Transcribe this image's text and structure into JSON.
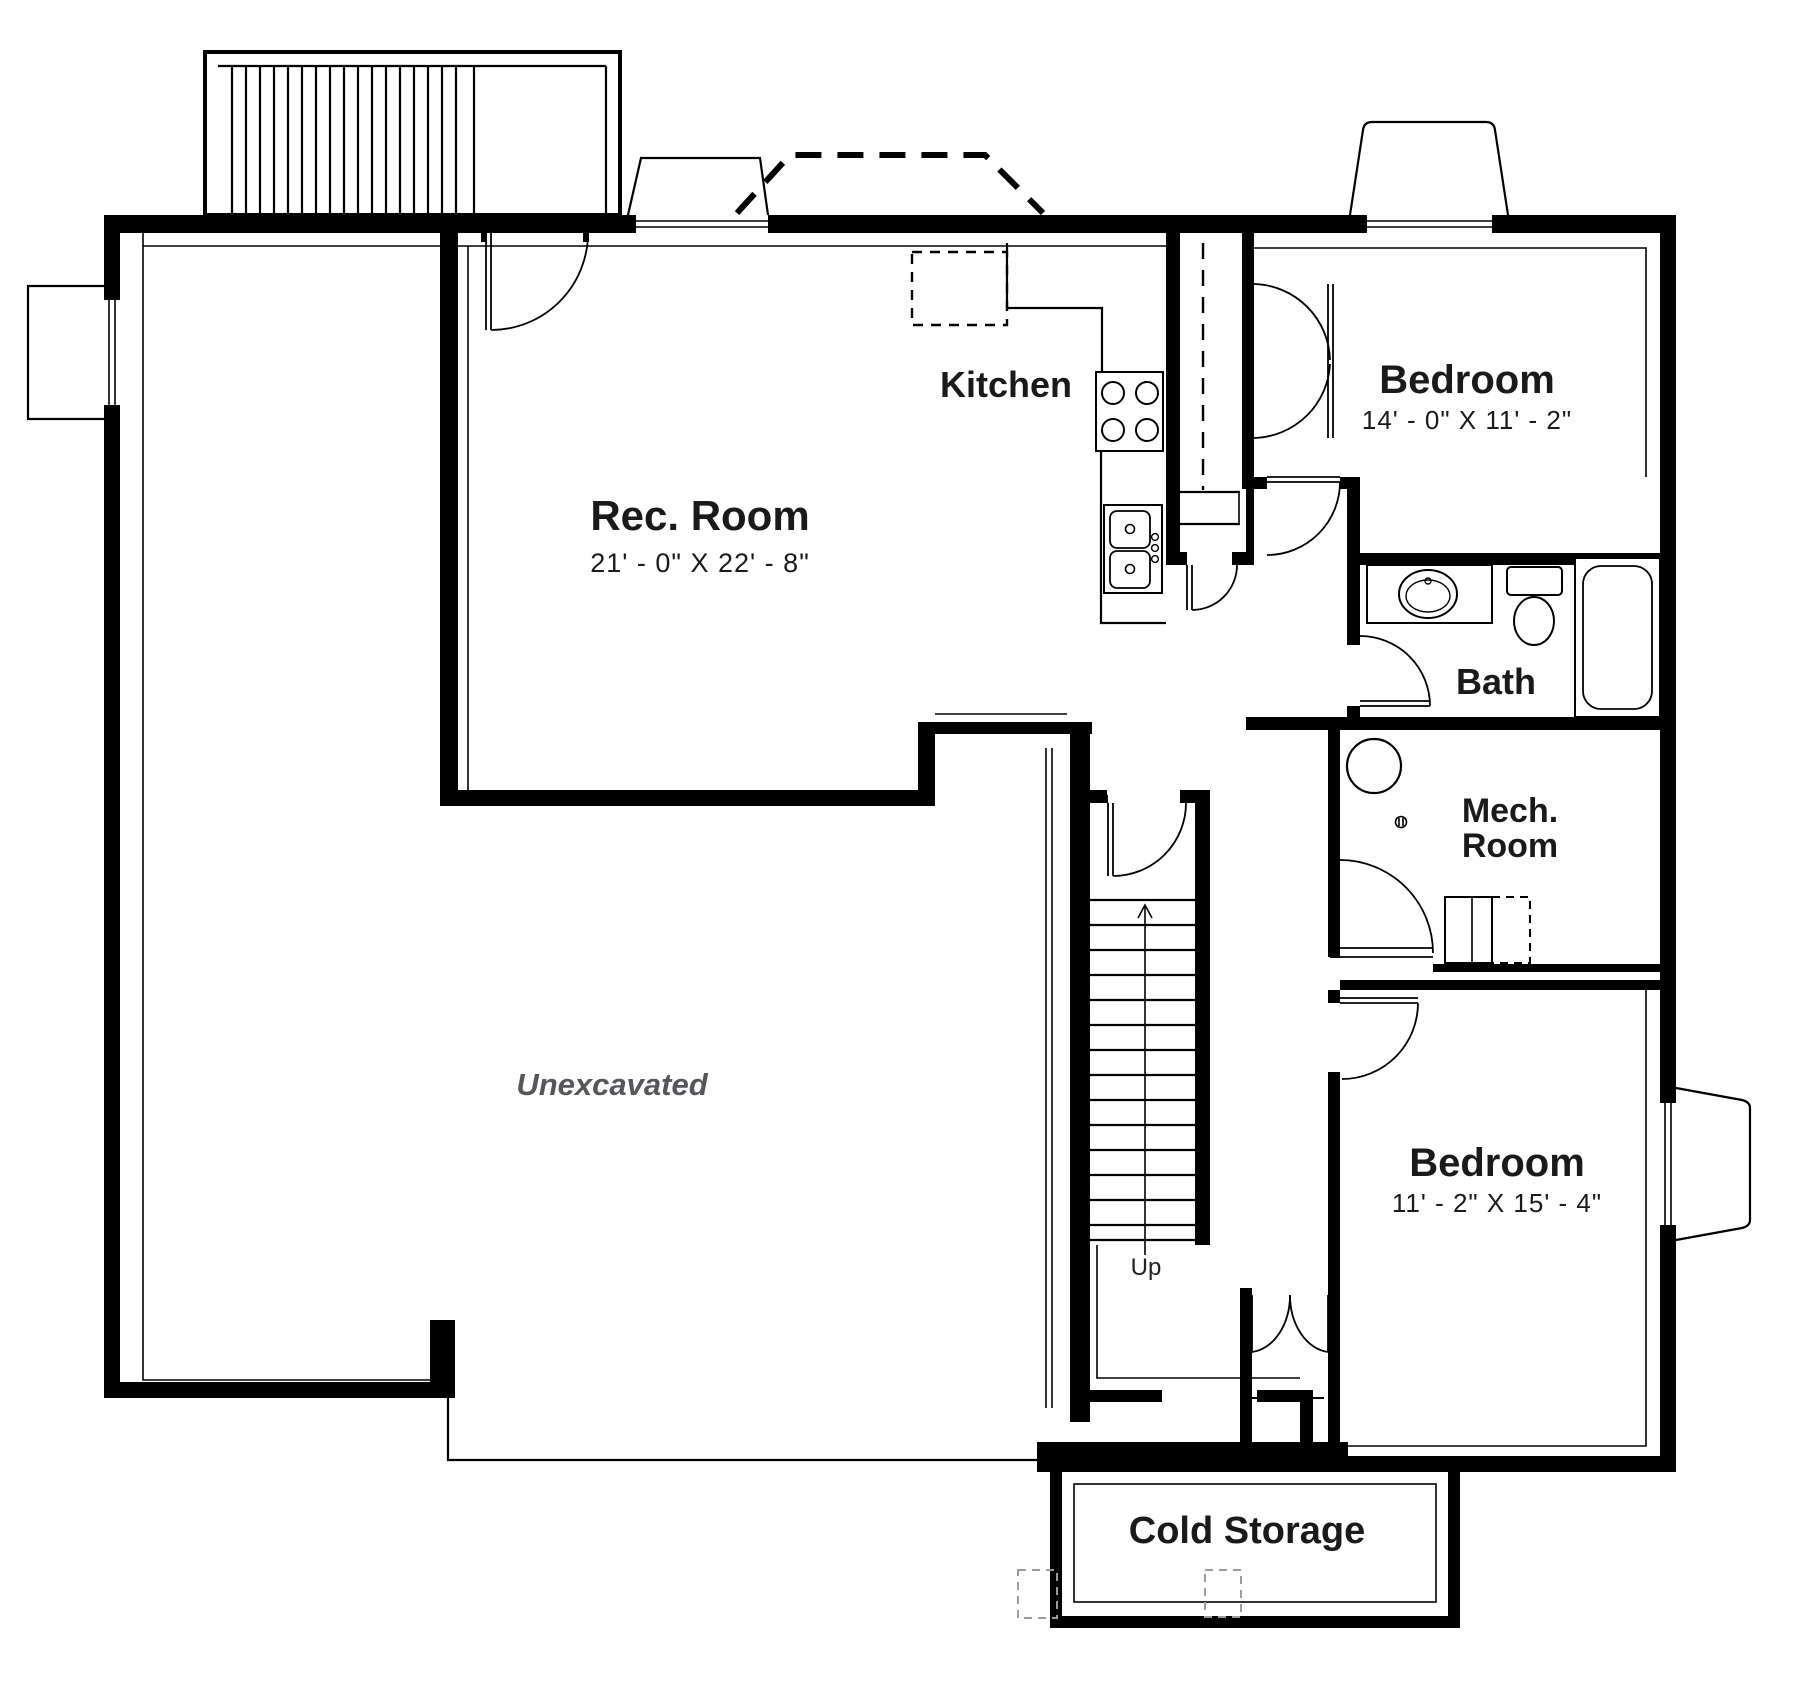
{
  "canvas": {
    "width": 1800,
    "height": 1700,
    "background_color": "#ffffff",
    "wall_color": "#000000",
    "label_color": "#1a1a1a",
    "muted_text_color": "#55565b",
    "footing_color": "#9b9b9b"
  },
  "rooms": {
    "rec_room": {
      "name": "Rec. Room",
      "dims": "21' - 0\" X 22' - 8\""
    },
    "kitchen": {
      "name": "Kitchen"
    },
    "bedroom_upper": {
      "name": "Bedroom",
      "dims": "14' - 0\" X 11' - 2\""
    },
    "bath": {
      "name": "Bath"
    },
    "mech_room": {
      "line1": "Mech.",
      "line2": "Room"
    },
    "bedroom_lower": {
      "name": "Bedroom",
      "dims": "11' - 2\" X 15' - 4\""
    },
    "unexcavated": {
      "name": "Unexcavated"
    },
    "cold_storage": {
      "name": "Cold Storage"
    }
  },
  "stairs": {
    "direction_label": "Up"
  },
  "fixtures": [
    "range-cooktop",
    "kitchen-sink",
    "refrigerator-dashed",
    "bathroom-sink",
    "toilet",
    "bathtub",
    "water-heater",
    "furnace",
    "floor-drain",
    "window-well",
    "exterior-stairs",
    "interior-stairs",
    "support-footings",
    "deck-outline-dashed",
    "closet-rod-dashed"
  ]
}
